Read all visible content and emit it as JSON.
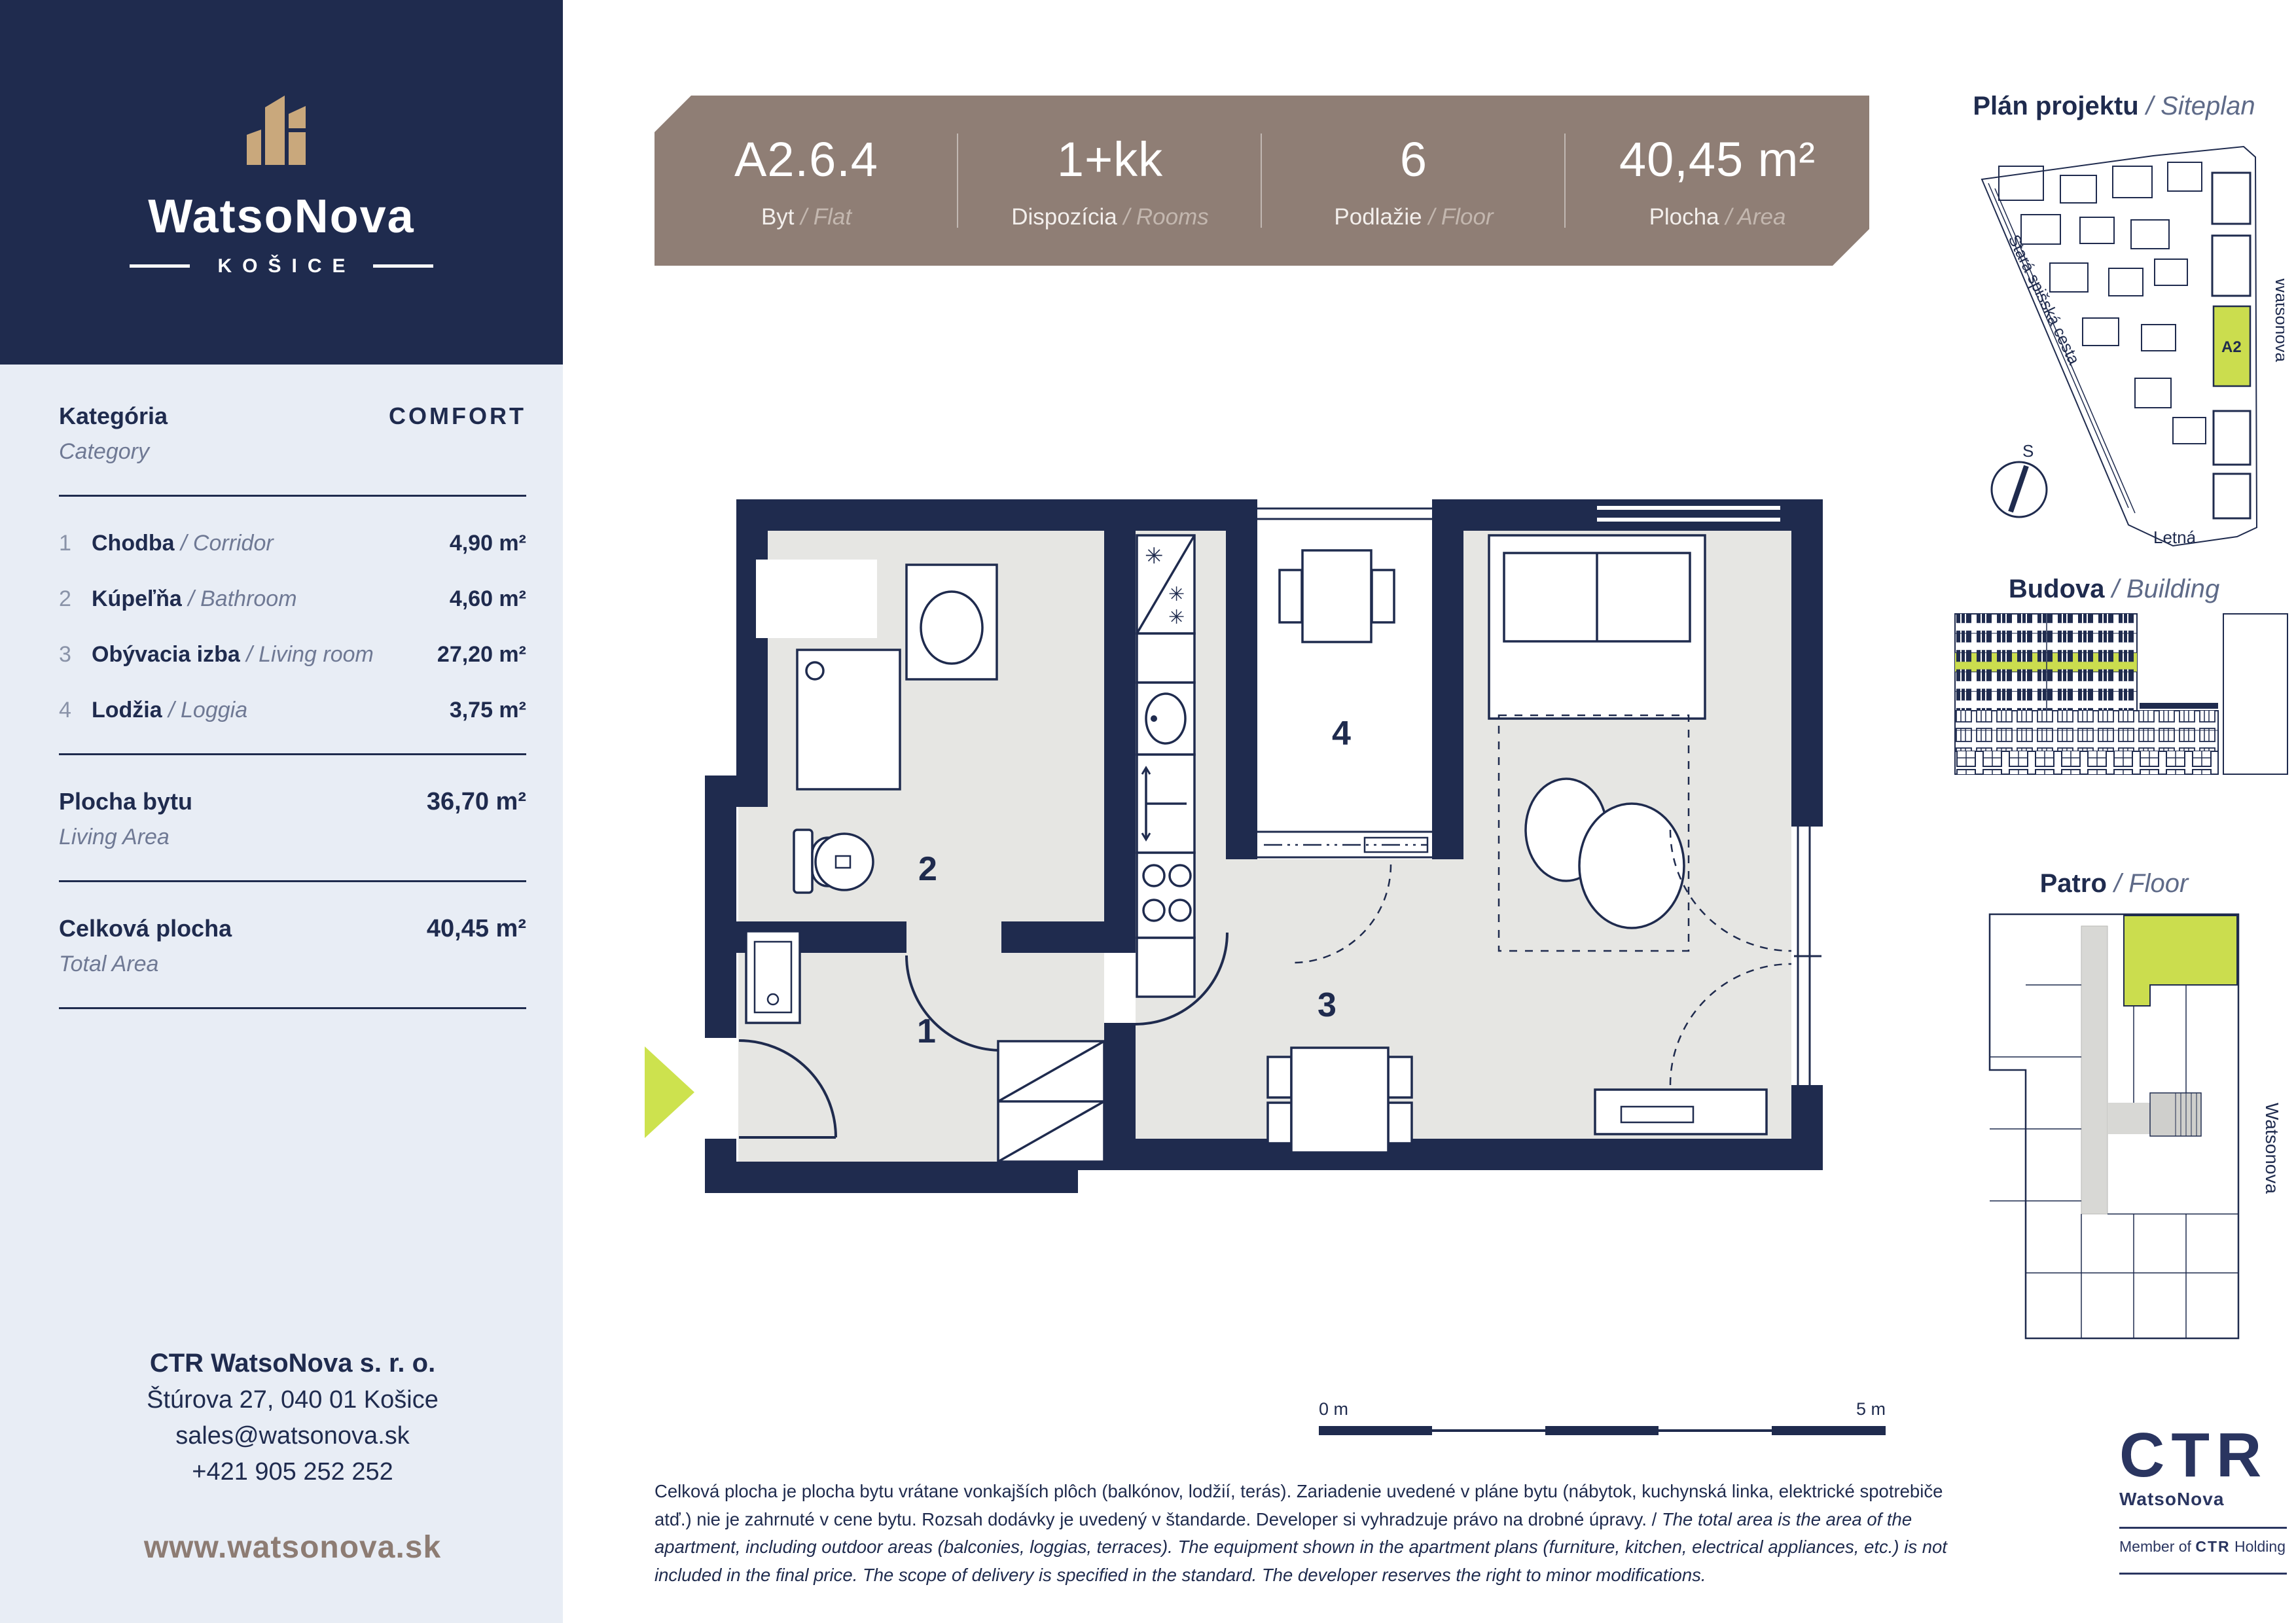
{
  "colors": {
    "navy": "#1f2b4e",
    "sidebar_bg": "#e8edf5",
    "banner_taupe": "#8f7e75",
    "logo_gold": "#c9a87c",
    "highlight_green": "#cbdd4e",
    "floor_gray": "#e6e6e3",
    "web_brown": "#8d7c73"
  },
  "sidebar": {
    "brand": {
      "name": "WatsoNova",
      "city": "KOŠICE"
    },
    "category_label_sk": "Kategória",
    "category_label_en": "Category",
    "category_value": "COMFORT",
    "rooms": [
      {
        "num": "1",
        "sk": "Chodba",
        "en": " Corridor",
        "area": "4,90 m²"
      },
      {
        "num": "2",
        "sk": "Kúpeľňa",
        "en": " Bathroom",
        "area": "4,60 m²"
      },
      {
        "num": "3",
        "sk": "Obývacia izba",
        "en": " Living room",
        "area": "27,20 m²"
      },
      {
        "num": "4",
        "sk": "Lodžia",
        "en": " Loggia",
        "area": "3,75 m²"
      }
    ],
    "living_area": {
      "sk": "Plocha bytu",
      "en": "Living Area",
      "value": "36,70 m²"
    },
    "total_area": {
      "sk": "Celková plocha",
      "en": "Total Area",
      "value": "40,45 m²"
    },
    "contact": {
      "company": "CTR WatsoNova s. r. o.",
      "address": "Štúrova 27, 040 01 Košice",
      "email": "sales@watsonova.sk",
      "phone": "+421 905 252 252",
      "web": "www.watsonova.sk"
    }
  },
  "banner": {
    "items": [
      {
        "value": "A2.6.4",
        "sk": "Byt",
        "en": " Flat"
      },
      {
        "value": "1+kk",
        "sk": "Dispozícia",
        "en": " Rooms"
      },
      {
        "value": "6",
        "sk": "Podlažie",
        "en": " Floor"
      },
      {
        "value": "40,45 m²",
        "sk": "Plocha",
        "en": " Area"
      }
    ]
  },
  "plan": {
    "room_labels": {
      "corridor": "1",
      "bathroom": "2",
      "living": "3",
      "loggia": "4"
    }
  },
  "side_panels": {
    "siteplan": {
      "title_sk": "Plán projektu",
      "title_en": " Siteplan",
      "street_left": "Stará spišská cesta",
      "street_right": "Watsonova",
      "street_bottom": "Letná",
      "highlight_label": "A2",
      "compass": "S"
    },
    "building": {
      "title_sk": "Budova",
      "title_en": " Building"
    },
    "floor": {
      "title_sk": "Patro",
      "title_en": " Floor",
      "street_right": "Watsonova"
    }
  },
  "footer": {
    "scale_start": "0 m",
    "scale_end": "5 m",
    "disclaimer_sk": "Celková plocha je plocha bytu vrátane vonkajších plôch (balkónov, lodžií, terás). Zariadenie uvedené v pláne bytu (nábytok, kuchynská linka, elektrické spotrebiče atď.) nie je zahrnuté v cene bytu. Rozsah dodávky je uvedený v štandarde. Developer si vyhradzuje právo na drobné úpravy. / ",
    "disclaimer_en": "The total area is the area of the apartment, including outdoor areas (balconies, loggias, terraces). The equipment shown in the apartment plans (furniture, kitchen, electrical appliances, etc.) is not included in the final price. The scope of delivery is specified in the standard. The developer reserves the right to minor modifications."
  },
  "ctr": {
    "logo": "CTR",
    "brand": "WatsoNova",
    "member_pre": "Member of ",
    "member_logo": "CTR",
    "member_post": " Holding"
  }
}
